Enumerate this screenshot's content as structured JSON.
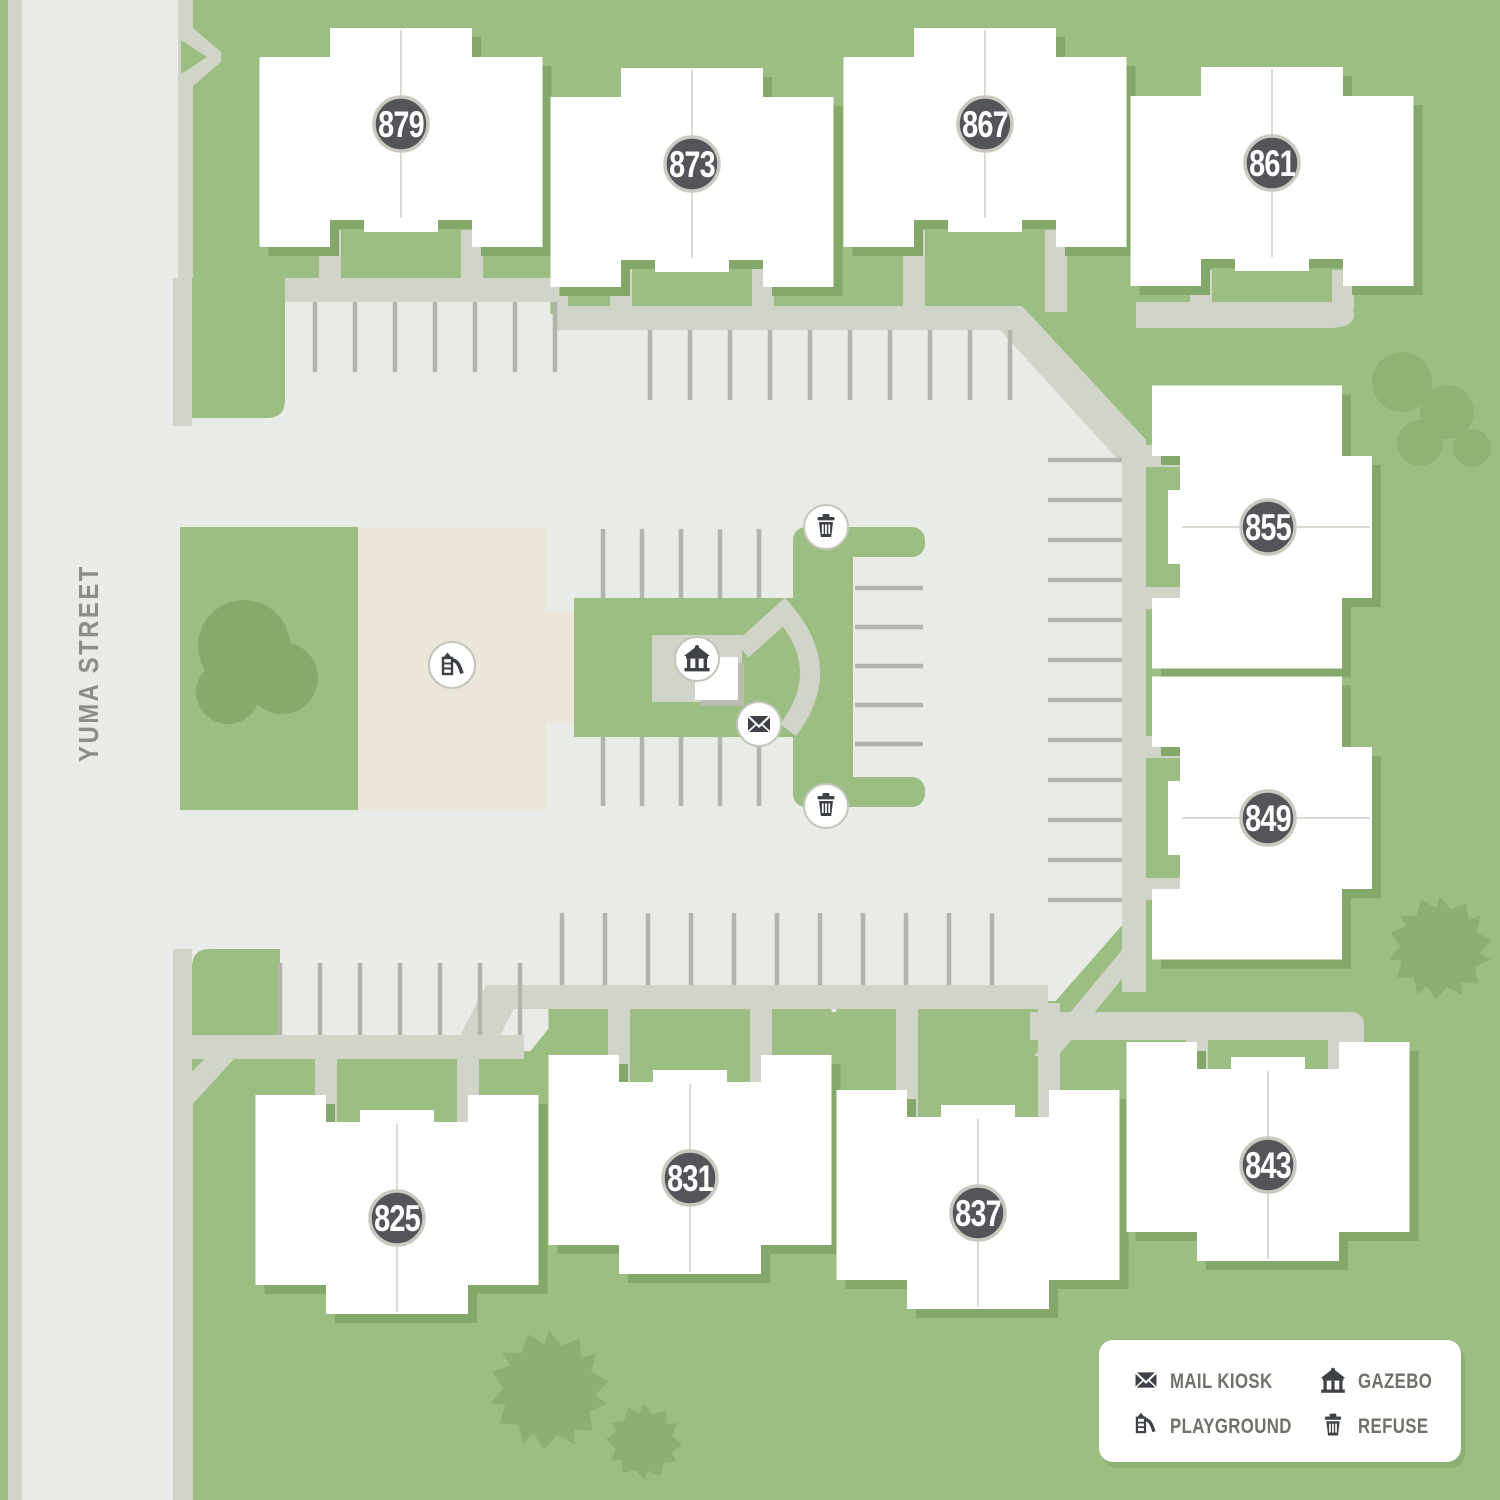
{
  "street": {
    "name": "YUMA STREET"
  },
  "buildings": [
    {
      "number": "879"
    },
    {
      "number": "873"
    },
    {
      "number": "867"
    },
    {
      "number": "861"
    },
    {
      "number": "855"
    },
    {
      "number": "849"
    },
    {
      "number": "825"
    },
    {
      "number": "831"
    },
    {
      "number": "837"
    },
    {
      "number": "843"
    }
  ],
  "amenities": {
    "markers": [
      {
        "type": "refuse"
      },
      {
        "type": "refuse"
      },
      {
        "type": "gazebo"
      },
      {
        "type": "mail_kiosk"
      },
      {
        "type": "playground"
      }
    ]
  },
  "legend": {
    "items": [
      {
        "icon": "mail-kiosk-icon",
        "label": "MAIL KIOSK"
      },
      {
        "icon": "gazebo-icon",
        "label": "GAZEBO"
      },
      {
        "icon": "playground-icon",
        "label": "PLAYGROUND"
      },
      {
        "icon": "refuse-icon",
        "label": "REFUSE"
      }
    ]
  },
  "palette": {
    "background_green": "#9dbe82",
    "pavement_gray": "#e9ebe7",
    "sidewalk_gray": "#d1d4c9",
    "stall_line_gray": "#b1b5ab",
    "playground_beige": "#ece5d9",
    "building_white": "#ffffff",
    "building_shadow": "#84a76a",
    "badge_dark": "#53555a",
    "badge_ring": "#cbc8c0",
    "icon_dark": "#3e4145",
    "legend_text": "#6f7269"
  }
}
